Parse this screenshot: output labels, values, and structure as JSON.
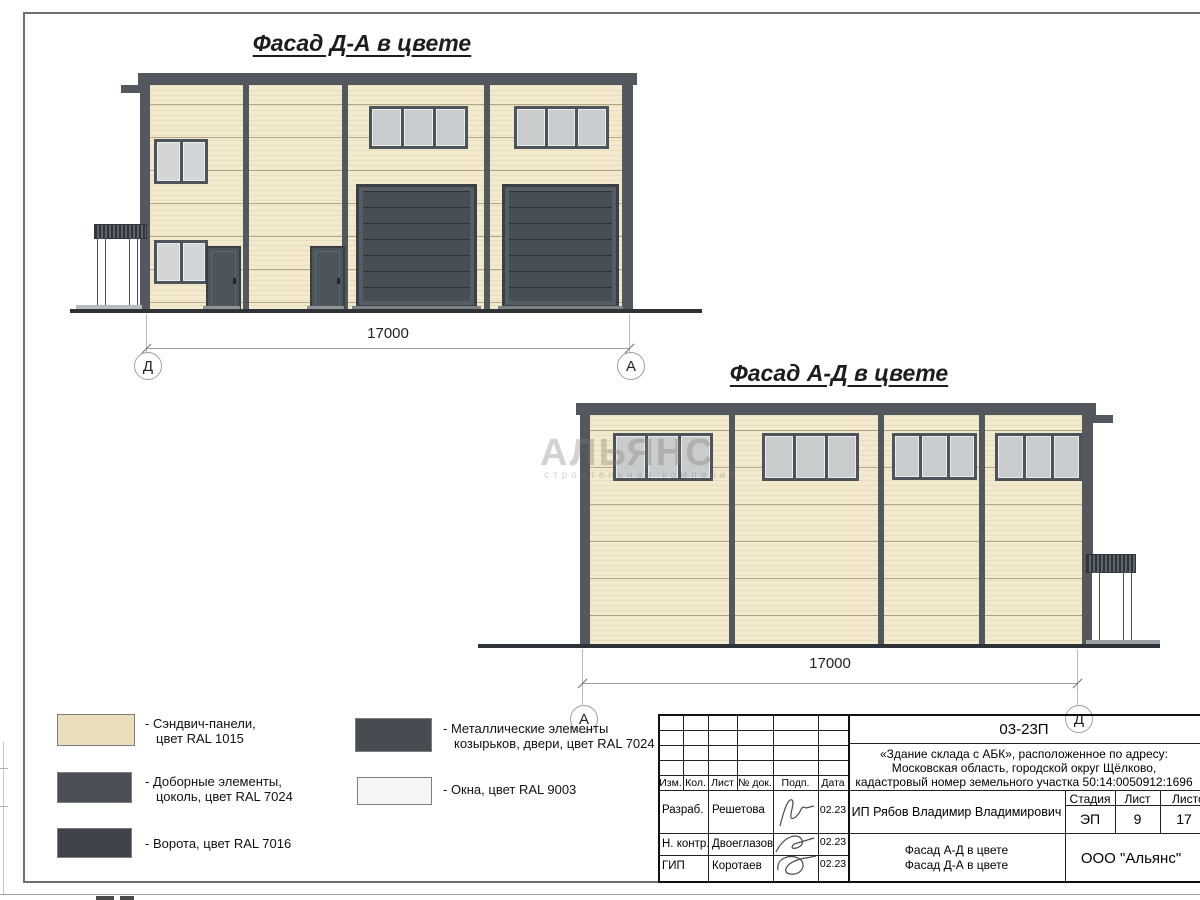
{
  "sheet": {
    "facade1": {
      "title": "Фасад Д-А в цвете",
      "dimension": "17000",
      "marker_left": "Д",
      "marker_right": "А"
    },
    "facade2": {
      "title": "Фасад А-Д в цвете",
      "dimension": "17000",
      "marker_left": "А",
      "marker_right": "Д"
    },
    "watermark": {
      "line1": "АЛЬЯНС",
      "line2": "строительная компания"
    },
    "legend": {
      "items": [
        {
          "line1": "- Сэндвич-панели,",
          "line2": "цвет RAL 1015",
          "color": "#eadebb"
        },
        {
          "line1": "- Доборные элементы,",
          "line2": "цоколь, цвет RAL 7024",
          "color": "#4a5056"
        },
        {
          "line1": "- Ворота, цвет RAL 7016",
          "line2": "",
          "color": "#3d4349"
        },
        {
          "line1": "- Металлические элементы",
          "line2": "козырьков, двери, цвет RAL 7024",
          "color": "#464c52"
        },
        {
          "line1": "- Окна, цвет RAL 9003",
          "line2": "",
          "color": "#f4f6f5"
        }
      ]
    },
    "titleblock": {
      "doc_number": "03-23П",
      "project_line1": "«Здание склада с АБК», расположенное по адресу:",
      "project_line2": "Московская область, городской округ Щёлково,",
      "project_line3": "кадастровый номер земельного участка 50:14:0050912:1696",
      "client": "ИП Рябов Владимир Владимирович",
      "sheet_title_line1": "Фасад А-Д в цвете",
      "sheet_title_line2": "Фасад Д-А в цвете",
      "company": "ООО \"Альянс\"",
      "stage_label": "Стадия",
      "sheet_label": "Лист",
      "sheets_label": "Листов",
      "stage_value": "ЭП",
      "sheet_value": "9",
      "sheets_value": "17",
      "col_headers": [
        "Изм.",
        "Кол.",
        "Лист",
        "№ док.",
        "Подп.",
        "Дата"
      ],
      "rows": [
        {
          "role": "Разраб.",
          "name": "Решетова",
          "date": "02.23"
        },
        {
          "role": "Н. контр.",
          "name": "Двоеглазов",
          "date": "02.23"
        },
        {
          "role": "ГИП",
          "name": "Коротаев",
          "date": "02.23"
        }
      ]
    }
  }
}
